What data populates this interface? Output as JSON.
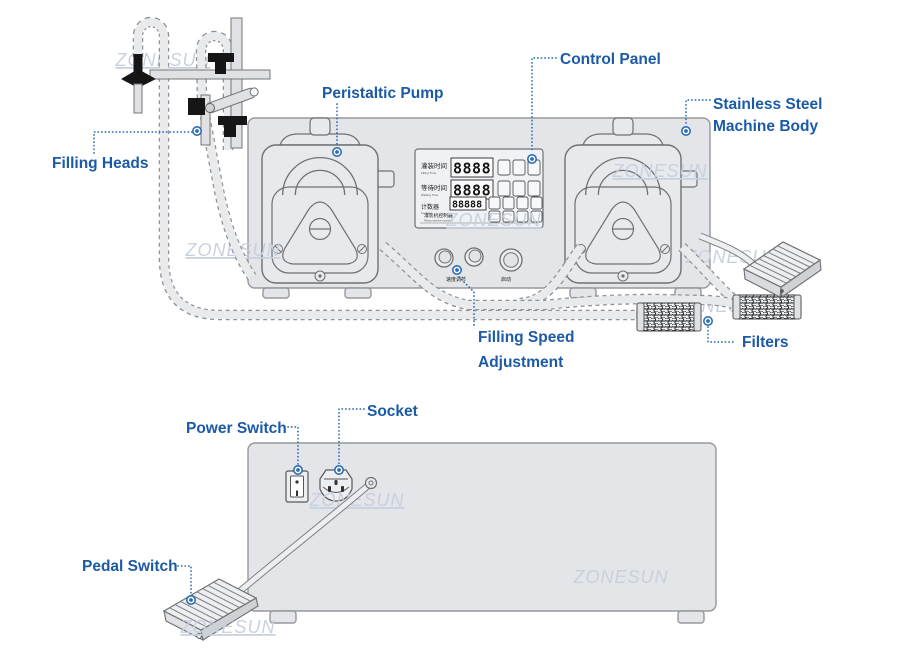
{
  "watermark": {
    "text": "ZONESUN"
  },
  "front_view": {
    "labels": {
      "filling_heads": "Filling Heads",
      "peristaltic_pump": "Peristaltic Pump",
      "control_panel": "Control Panel",
      "stainless_line1": "Stainless Steel",
      "stainless_line2": "Machine Body",
      "filling_speed_line1": "Filling Speed",
      "filling_speed_line2": "Adjustment",
      "filters": "Filters"
    },
    "control_panel": {
      "rows": [
        {
          "zh": "灌装时间",
          "en": "Filling Time",
          "value": "8888"
        },
        {
          "zh": "等待时间",
          "en": "Waiting Time",
          "value": "8888"
        },
        {
          "zh": "计数器",
          "en": "Counter",
          "value": "88888"
        }
      ],
      "footer_zh": "灌装机控制器",
      "footer_en": "Filling machine controller",
      "knob_speed_label": "速度调节",
      "knob_start_label": "启动"
    }
  },
  "back_view": {
    "labels": {
      "power_switch": "Power Switch",
      "socket": "Socket",
      "pedal_switch": "Pedal Switch"
    }
  },
  "colors": {
    "label_blue": "#1c5aa6",
    "leader_blue": "#2e6db4",
    "watermark_gray_blue": "#c6d0dd",
    "machine_gray": "#e4e5e8",
    "outline_gray": "#6e7073"
  }
}
